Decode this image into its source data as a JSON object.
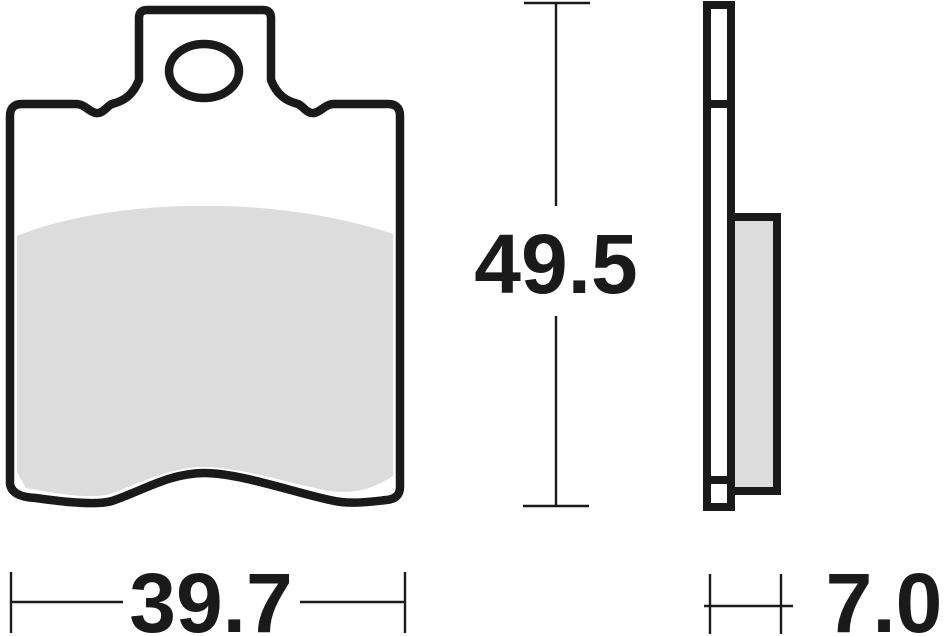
{
  "drawing": {
    "colors": {
      "line": "#1a1a1a",
      "friction": "#dcdcdc",
      "plate": "#ffffff",
      "background": "#ffffff"
    },
    "dimensions": {
      "height": {
        "label": "49.5"
      },
      "width": {
        "label": "39.7"
      },
      "thickness": {
        "label": "7.0"
      }
    }
  }
}
